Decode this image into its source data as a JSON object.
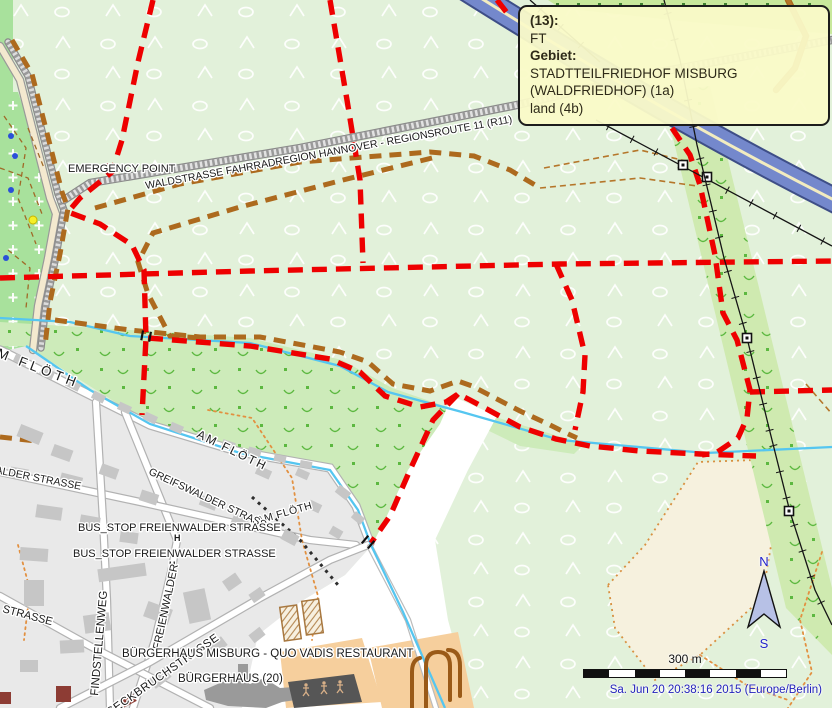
{
  "tooltip": {
    "rows": [
      {
        "text": "(13):",
        "bold": true
      },
      {
        "text": "FT",
        "bold": false
      },
      {
        "text": "Gebiet:",
        "bold": true
      },
      {
        "text": "STADTTEILFRIEDHOF MISBURG (WALDFRIEDHOF) (1a)",
        "bold": false
      },
      {
        "text": "land (4b)",
        "bold": false
      }
    ]
  },
  "compass": {
    "north": "N",
    "south": "S"
  },
  "scale": {
    "label": "300 m"
  },
  "status": {
    "timestamp": "Sa. Jun 20 20:38:16 2015 (Europe/Berlin)"
  },
  "palette": {
    "forest": "#e2f1da",
    "scrub": "#cdebba",
    "cemetery": "#a8e19c",
    "urban": "#e9e9e9",
    "route_red": "#ee0000",
    "route_brown": "#ad6a1e",
    "stream": "#55c6f0",
    "motorway_fill": "#7488cc",
    "motorway_casing": "#3e4e87",
    "motorway_mid": "#f2ecc0",
    "orange_ground": "#f6cf9d",
    "cream": "#f6f1de",
    "dotted_path": "#e29040",
    "power": "#141414",
    "building": "#c6c6c6",
    "timestamp_blue": "#2222bb",
    "compass_fill": "#b7c1e6",
    "tooltip_bg": "#fafac8"
  },
  "map": {
    "areas": [
      {
        "n": "forest-background",
        "pts": "0,0 832,0 832,708 0,708",
        "f": "#e2f1da",
        "p": "trees"
      },
      {
        "n": "hedge-strip-top",
        "pts": "548,0 832,0 832,34 690,22 560,8",
        "f": "#c8e89c"
      },
      {
        "n": "scrub-topleft-strip",
        "pts": "0,0 13,0 13,96 0,96",
        "f": "#a8e19c"
      },
      {
        "n": "cemetery-area",
        "pts": "0,92 18,92 58,212 48,262 34,312 28,352 0,352",
        "f": "#a8e19c",
        "p": "crosses"
      },
      {
        "n": "scrub-stream-band",
        "pts": "0,322 130,330 250,338 342,360 392,388 450,408 440,424 408,470 385,520 372,545 358,508 330,468 240,452 150,424 26,346 0,346",
        "f": "#cdebba",
        "p": "scrubm"
      },
      {
        "n": "scrub-sliver",
        "pts": "452,404 545,432 584,444 574,454 520,446 458,416",
        "f": "#cdebba"
      },
      {
        "n": "white-clearing",
        "pts": "452,396 497,416 468,470 435,540 448,620 472,708 240,708 250,640 300,602 345,575 372,545 385,520 408,470 440,424",
        "f": "#ffffff"
      },
      {
        "n": "cream-field",
        "pts": "608,585 645,545 698,462 756,460 772,540 762,598 700,655 655,680 615,628",
        "f": "#f6f1de",
        "s": "#d89040",
        "sd": "2 4",
        "sw": 1.8
      },
      {
        "n": "urban-area",
        "pts": "0,352 26,346 90,390 150,424 240,452 330,468 358,508 372,545 345,575 300,602 258,635 242,708 0,708",
        "f": "#e9e9e9"
      },
      {
        "n": "scrub-power-band",
        "pts": "662,92 710,86 832,588 832,655 786,608",
        "f": "#cfeab0",
        "p": "scrubm"
      },
      {
        "n": "orange-ground-a",
        "pts": "280,652 362,638 382,702 286,708",
        "f": "#f6cf9d"
      },
      {
        "n": "orange-ground-b",
        "pts": "368,648 458,632 474,708 382,708",
        "f": "#f6cf9d"
      }
    ],
    "hedgedots": {
      "y": 3,
      "x0": 556,
      "x1": 828,
      "step": 21,
      "size": 3,
      "color": "#3f8030"
    },
    "roads": [
      {
        "n": "road-bundle-cream",
        "pts": "0,46 20,80 50,198 56,214 48,258 38,306 33,350",
        "w": 6,
        "c": "#999999",
        "f": "#f3e9cf"
      },
      {
        "n": "road-bundle-track",
        "pts": "8,42 28,76 58,194 64,210 56,256 46,304 41,348",
        "w": 5,
        "c": "#8a8a8a",
        "f": "#dcdcdc",
        "hd": "2.5 2.5"
      },
      {
        "n": "road-waldstrasse-r11",
        "pts": "64,200 90,183 300,148 517,105 660,72 832,40",
        "w": 6,
        "c": "#8a8a8a",
        "f": "#e2e2e2",
        "hd": "2.5 2.5"
      },
      {
        "n": "road-am-floeth",
        "pts": "0,350 150,425 240,452 330,468 356,506 370,543",
        "w": 7,
        "c": "#b2b2b2",
        "f": "#ffffff"
      },
      {
        "n": "road-freienwalder",
        "pts": "125,412 160,498 177,540 172,568 155,640 133,708",
        "w": 6,
        "c": "#b2b2b2",
        "f": "#ffffff"
      },
      {
        "n": "road-greifswalder",
        "pts": "0,472 140,502 310,540 356,545",
        "w": 6,
        "c": "#b2b2b2",
        "f": "#ffffff"
      },
      {
        "n": "road-findstellenweg",
        "pts": "96,402 103,520 107,600 110,708",
        "w": 6,
        "c": "#b2b2b2",
        "f": "#ffffff"
      },
      {
        "n": "road-south",
        "pts": "0,596 90,646 210,708",
        "w": 6,
        "c": "#b2b2b2",
        "f": "#ffffff"
      },
      {
        "n": "road-seckbruch",
        "pts": "60,708 150,662 260,598 330,560 368,545",
        "w": 6,
        "c": "#b2b2b2",
        "f": "#ffffff"
      },
      {
        "n": "road-field",
        "pts": "370,547 408,620 436,708",
        "w": 4,
        "c": "#bbbbbb",
        "f": "#ffffff"
      },
      {
        "n": "road-topright-brown",
        "pts": "788,0 806,36 795,68 776,90",
        "w": 4,
        "c": "#a8681c",
        "f": "#b5762a"
      }
    ],
    "motorway": {
      "n": "motorway",
      "d": "M452,-20 C560,48 690,128 850,208"
    },
    "streams": [
      {
        "n": "stream-main",
        "pts": "0,318 70,322 130,336 250,343 340,366 388,392 462,412 560,440 706,453 832,447"
      },
      {
        "n": "stream-floeth",
        "pts": "26,346 90,390 150,424 240,453 330,470 358,510 371,545 403,612 445,708"
      }
    ],
    "paths": [
      {
        "n": "path-dotted-forest",
        "pts": "208,410 252,418 292,478 302,540 318,596 312,640",
        "st": "dotorange"
      },
      {
        "n": "path-dotted-east-edge",
        "pts": "822,552 800,620 812,672 788,708",
        "st": "dotorange"
      },
      {
        "n": "path-dotted-se",
        "pts": "700,655 748,686 788,700",
        "st": "dotorange"
      },
      {
        "n": "path-dotted-urban",
        "pts": "18,545 30,590 24,640",
        "st": "dotorange"
      },
      {
        "n": "path-track-thin-1",
        "pts": "540,188 640,178 697,186",
        "st": "thinbrown"
      },
      {
        "n": "path-track-thin-2",
        "pts": "544,168 640,150 690,162",
        "st": "thinbrown"
      },
      {
        "n": "path-track-thin-3",
        "pts": "806,384 832,414",
        "st": "thinbrown"
      },
      {
        "n": "path-black-dotted",
        "pts": "252,497 300,540 338,585",
        "st": "dotblack"
      },
      {
        "n": "cemetery-path-1",
        "pts": "4,116 26,148 18,198 36,244",
        "st": "dashcem"
      },
      {
        "n": "cemetery-path-2",
        "pts": "0,168 28,178 42,214",
        "st": "dashcem"
      },
      {
        "n": "cemetery-path-3",
        "pts": "8,250 30,268 26,308",
        "st": "dashcem"
      },
      {
        "n": "cemetery-path-4",
        "pts": "28,128 44,168",
        "st": "dashcem"
      }
    ],
    "routes": [
      {
        "n": "route-brown-loop",
        "pts": "95,208 180,184 300,162 430,152 474,156 510,170 540,188",
        "st": "brown"
      },
      {
        "n": "route-brown-return",
        "pts": "432,158 343,180 240,207 153,233 138,262 148,294 170,336 200,338",
        "st": "brown"
      },
      {
        "n": "route-brown-stream",
        "pts": "55,320 130,330 200,337 260,337 340,352 368,362 393,384 430,391 458,381 472,386 520,411 548,424 566,433 577,438",
        "st": "brown"
      },
      {
        "n": "route-brown-bundle",
        "pts": "12,40 32,74 62,192 68,208 60,254 50,302 45,346",
        "st": "brown"
      },
      {
        "n": "route-brown-seg",
        "pts": "0,437 36,441",
        "st": "brown"
      },
      {
        "n": "route-red-northwest",
        "pts": "153,0 138,62 122,140 112,172 80,198 68,212 100,224 132,245 144,270 146,338 142,415",
        "st": "red"
      },
      {
        "n": "route-red-north",
        "pts": "330,0 347,100 360,180 363,263",
        "st": "red"
      },
      {
        "n": "route-red-horizontal",
        "pts": "0,278 250,271 560,264 832,261",
        "st": "red"
      },
      {
        "n": "route-red-mid",
        "pts": "556,264 572,300 585,355 583,392 575,430",
        "st": "red"
      },
      {
        "n": "route-red-stream",
        "pts": "148,338 250,346 330,359 360,372 385,396 420,407 446,402 458,394 470,400 520,427 556,439 590,446 640,451 700,454 756,456",
        "st": "red"
      },
      {
        "n": "route-red-east",
        "pts": "672,128 690,155 700,185 715,255 723,313 737,340 750,390 747,418 738,438 716,453 702,455",
        "st": "red"
      },
      {
        "n": "route-red-east-h",
        "pts": "750,392 832,390",
        "st": "red"
      },
      {
        "n": "route-red-diagonal",
        "pts": "458,394 433,420 410,470 390,516 371,543",
        "st": "red"
      },
      {
        "n": "route-red-top",
        "pts": "497,0 511,18",
        "st": "red"
      }
    ],
    "power": [
      {
        "n": "power-line-top",
        "pts": "530,0 600,62",
        "pylons": []
      },
      {
        "n": "power-line-diag",
        "pts": "596,120 832,246",
        "pylons": [
          [
            683,
            165
          ],
          [
            707,
            177
          ]
        ]
      },
      {
        "n": "power-line-vert",
        "pts": "664,0 680,60 697,145 724,258 747,338 770,432 790,512 815,590 832,625",
        "pylons": [
          [
            747,
            338
          ],
          [
            789,
            511
          ]
        ]
      }
    ],
    "bridges": [
      [
        146,
        336,
        10
      ],
      [
        368,
        542,
        40
      ]
    ],
    "buildings": [
      [
        14,
        356,
        14,
        8,
        25
      ],
      [
        40,
        369,
        14,
        8,
        25
      ],
      [
        66,
        381,
        14,
        8,
        27
      ],
      [
        92,
        393,
        13,
        8,
        27
      ],
      [
        118,
        404,
        13,
        8,
        25
      ],
      [
        144,
        414,
        13,
        8,
        25
      ],
      [
        170,
        424,
        13,
        8,
        23
      ],
      [
        196,
        433,
        13,
        8,
        20
      ],
      [
        222,
        441,
        13,
        8,
        18
      ],
      [
        248,
        448,
        13,
        8,
        15
      ],
      [
        274,
        455,
        12,
        7,
        12
      ],
      [
        300,
        461,
        12,
        7,
        10
      ],
      [
        18,
        428,
        24,
        13,
        22
      ],
      [
        52,
        447,
        20,
        12,
        20
      ],
      [
        10,
        468,
        18,
        11,
        10
      ],
      [
        60,
        475,
        22,
        12,
        14
      ],
      [
        100,
        466,
        18,
        11,
        20
      ],
      [
        140,
        492,
        18,
        11,
        18
      ],
      [
        36,
        506,
        26,
        13,
        8
      ],
      [
        80,
        516,
        20,
        11,
        10
      ],
      [
        120,
        532,
        18,
        11,
        8
      ],
      [
        200,
        498,
        17,
        10,
        22
      ],
      [
        232,
        516,
        15,
        10,
        24
      ],
      [
        256,
        468,
        15,
        9,
        24
      ],
      [
        282,
        532,
        16,
        11,
        28
      ],
      [
        308,
        502,
        13,
        9,
        26
      ],
      [
        330,
        528,
        12,
        9,
        30
      ],
      [
        336,
        488,
        14,
        9,
        38
      ],
      [
        352,
        514,
        12,
        8,
        40
      ],
      [
        296,
        470,
        13,
        8,
        24
      ],
      [
        20,
        548,
        28,
        13,
        4
      ],
      [
        24,
        580,
        20,
        26,
        0
      ],
      [
        98,
        566,
        48,
        13,
        -8
      ],
      [
        84,
        614,
        26,
        18,
        -8
      ],
      [
        150,
        600,
        16,
        26,
        -70
      ],
      [
        186,
        590,
        22,
        32,
        -12
      ],
      [
        224,
        576,
        16,
        12,
        -35
      ],
      [
        250,
        590,
        14,
        10,
        -35
      ],
      [
        60,
        640,
        24,
        13,
        -3
      ],
      [
        20,
        660,
        18,
        12,
        0
      ],
      [
        150,
        672,
        20,
        12,
        -38
      ],
      [
        210,
        640,
        16,
        11,
        -38
      ],
      [
        250,
        630,
        14,
        10,
        -38
      ],
      [
        238,
        664,
        10,
        16,
        0,
        "#9a9a9a"
      ],
      [
        56,
        686,
        15,
        16,
        0,
        "#8d3c34"
      ],
      [
        0,
        692,
        11,
        12,
        0,
        "#8d3c34"
      ],
      [
        116,
        698,
        20,
        8,
        -28,
        "#8d3c34"
      ]
    ],
    "special": {
      "playground": {
        "n": "playground-area",
        "pts": "288,682 354,674 362,702 294,708",
        "f": "#565656",
        "figs": [
          [
            306,
            690
          ],
          [
            324,
            688
          ],
          [
            340,
            687
          ]
        ]
      },
      "buergerhaus": {
        "n": "buergerhaus-building",
        "pts": "204,690 236,676 250,684 264,678 280,688 308,686 310,698 282,702 266,708 228,706 206,700",
        "f": "#9a9a9a"
      },
      "greenhouses": [
        [
          282,
          606,
          17,
          34,
          -8
        ],
        [
          304,
          600,
          17,
          34,
          -8
        ]
      ],
      "slides": [
        "M412,708 L412,672 Q412,660 420,658",
        "M426,708 L426,666 Q426,652 438,652 Q450,652 450,666 L450,700",
        "M460,696 L460,666 Q460,650 448,650"
      ]
    },
    "markers": {
      "emergency": {
        "x": 106,
        "y": 164,
        "w": 9,
        "h": 9
      },
      "busstops": [
        [
          174,
          533
        ],
        [
          169,
          560
        ]
      ],
      "cemdots": {
        "blue": [
          [
            11,
            136
          ],
          [
            15,
            156
          ],
          [
            11,
            190
          ],
          [
            6,
            258
          ]
        ],
        "yellow": [
          33,
          220
        ]
      }
    },
    "labels": [
      {
        "n": "label-emergency-point",
        "t": "EMERGENCY POINT",
        "x": 68,
        "y": 172,
        "s": 11
      },
      {
        "n": "label-waldstrasse-r11",
        "t": "WALDSTRASSE FAHRRADREGION HANNOVER - REGIONSROUTE 11 (R11)",
        "x": 146,
        "y": 189,
        "r": -10.3,
        "s": 10.5
      },
      {
        "n": "label-am-floeth-1",
        "t": "AM FLÖTH",
        "x": -16,
        "y": 352,
        "r": 21,
        "s": 13.5,
        "ls": 4
      },
      {
        "n": "label-am-floeth-2",
        "t": "AM FLÖTH",
        "x": 196,
        "y": 437,
        "r": 26,
        "s": 12,
        "ls": 2
      },
      {
        "n": "label-am-floeth-3",
        "t": "AM FLÖTH",
        "x": 258,
        "y": 524,
        "r": -16,
        "s": 10.5,
        "ls": 0.5
      },
      {
        "n": "label-freienwalder-frag",
        "t": "FREIENWALDER STRASSE",
        "x": -52,
        "y": 464,
        "r": 11,
        "s": 10.5
      },
      {
        "n": "label-greifswalder",
        "t": "GREIFSWALDER STRASSE",
        "x": 148,
        "y": 474,
        "r": 25,
        "s": 10.5
      },
      {
        "n": "label-bus-stop-1",
        "t": "BUS_STOP FREIENWALDER STRASSE",
        "x": 78,
        "y": 531,
        "s": 11
      },
      {
        "n": "label-bus-stop-2",
        "t": "BUS_STOP FREIENWALDER STRASSE",
        "x": 73,
        "y": 557,
        "s": 11
      },
      {
        "n": "label-findstellenweg",
        "t": "FINDSTELLENWEG",
        "x": 98,
        "y": 696,
        "r": -85,
        "s": 11.5
      },
      {
        "n": "label-freienwalder-vert",
        "t": "FREIENWALDER",
        "x": 160,
        "y": 650,
        "r": -78,
        "s": 11
      },
      {
        "n": "label-seckbruchstrasse",
        "t": "SECKBRUCHSTRASSE",
        "x": 110,
        "y": 716,
        "r": -35,
        "s": 11.5,
        "ls": 0.5
      },
      {
        "n": "label-strasse-frag",
        "t": "STRASSE",
        "x": 2,
        "y": 612,
        "r": 15,
        "s": 11
      },
      {
        "n": "label-buergerhaus-quovadis",
        "t": "BÜRGERHAUS MISBURG - QUO VADIS RESTAURANT",
        "x": 122,
        "y": 657,
        "s": 11.5
      },
      {
        "n": "label-buergerhaus-20",
        "t": "BÜRGERHAUS (20)",
        "x": 178,
        "y": 682,
        "s": 11.5
      }
    ]
  }
}
